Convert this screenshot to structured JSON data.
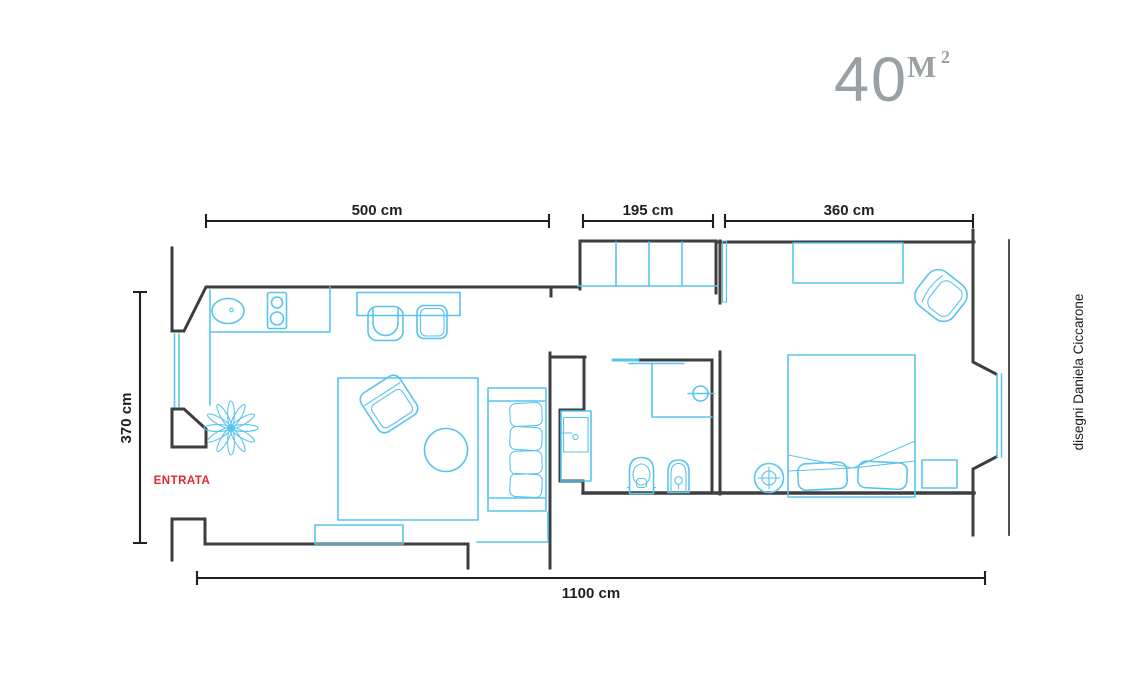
{
  "title": {
    "area_number": "40",
    "area_unit": "M",
    "area_exponent": "2"
  },
  "dimensions": {
    "living_width": "500 cm",
    "hallway_width": "195 cm",
    "bedroom_width": "360 cm",
    "apartment_depth": "370 cm",
    "apartment_length": "1100 cm"
  },
  "labels": {
    "entrance": "ENTRATA",
    "credit": "disegni Daniela Ciccarone"
  },
  "colors": {
    "wall": "#3e3e40",
    "furniture": "#58c4ec",
    "entrance_red": "#e8242e",
    "title_gray": "#9aa0a3",
    "ink": "#231f20"
  }
}
